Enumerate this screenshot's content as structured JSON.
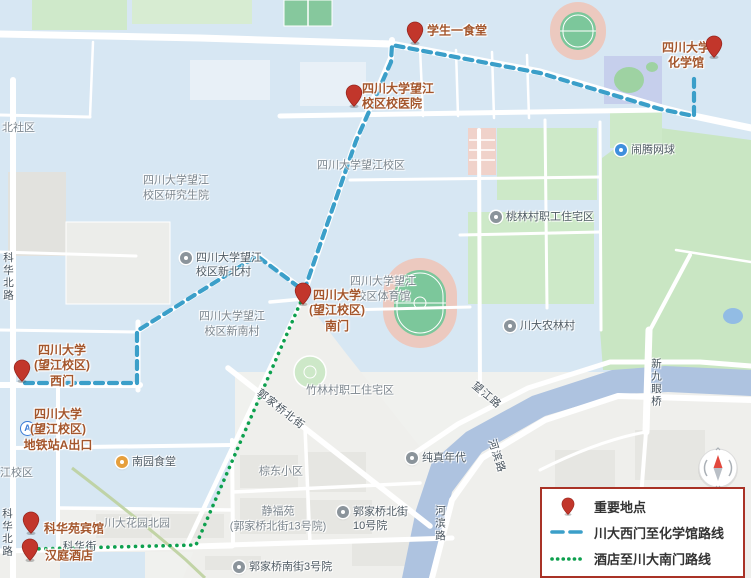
{
  "colors": {
    "route_blue": "#3b9fc9",
    "route_green": "#0da04e",
    "pin_red": "#c2362b",
    "legend_border": "#a93226"
  },
  "legend": {
    "pin_label": "重要地点",
    "route_blue_label": "川大西门至化学馆路线",
    "route_green_label": "酒店至川大南门路线"
  },
  "places": {
    "canteen1": "学生一食堂",
    "chemistry": "四川大学\n化学馆",
    "hospital": "四川大学望江\n校区校医院",
    "south_gate": "四川大学\n(望江校区)\n南门",
    "west_gate": "四川大学\n(望江校区)\n西门",
    "metro": "四川大学\n(望江校区)\n地铁站A出口",
    "metro_icon_letter": "A",
    "kehuayuan_hotel": "科华苑宾馆",
    "hanting_hotel": "汉庭酒店"
  },
  "pois": {
    "xinbeicun": "四川大学望江\n校区新北村",
    "taolin": "桃林村职工住宅区",
    "nonglin": "川大农林村",
    "naoteng": "闹腾网球",
    "nanyuan": "南园食堂",
    "chunzhen": "纯真年代",
    "gjq10": "郭家桥北街\n10号院",
    "gjqnan": "郭家桥南街3号院"
  },
  "areas": {
    "beishequ": "北社区",
    "grad": "四川大学望江\n校区研究生院",
    "wangjiang": "四川大学望江校区",
    "tiyuguan": "四川大学望江\n校区体育馆",
    "xinnancun": "四川大学望江\n校区新南村",
    "zhulin": "竹林村职工住宅区",
    "zongdong": "棕东小区",
    "jingfuyuan": "静福苑\n(郭家桥北街13号院)",
    "huayuan": "川大花园北园",
    "jiangxiaoqu": "江校区"
  },
  "roads": {
    "kehua_north": "科华北路",
    "kehua_street": "科华街",
    "guojiaqiao_beijie": "郭家桥北街",
    "wangjiang_road": "望江路",
    "hebin_road": "河滨路",
    "xinjiuyanqiao": "新九眼桥"
  }
}
